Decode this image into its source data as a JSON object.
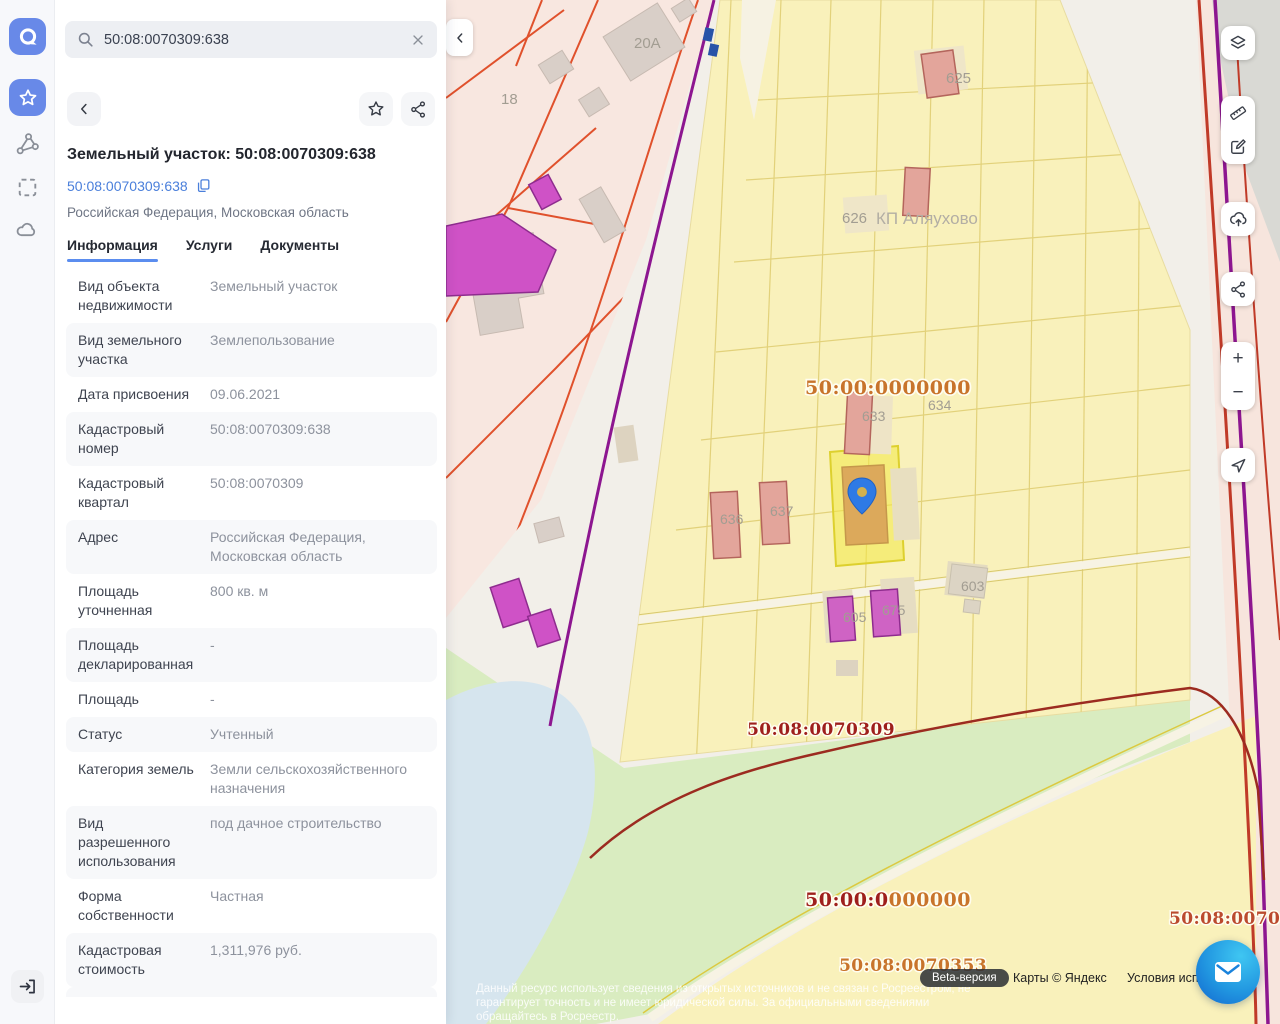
{
  "sidebar": {
    "items": [
      {
        "name": "app-logo"
      },
      {
        "name": "favorites",
        "active": true
      },
      {
        "name": "polygon-tool"
      },
      {
        "name": "select-area-tool"
      },
      {
        "name": "cloud-tool"
      },
      {
        "name": "login"
      }
    ]
  },
  "search": {
    "value": "50:08:0070309:638"
  },
  "panel": {
    "title": "Земельный участок: 50:08:0070309:638",
    "cadastral_link": "50:08:0070309:638",
    "region": "Российская Федерация, Московская область",
    "tabs": [
      {
        "label": "Информация",
        "active": true
      },
      {
        "label": "Услуги",
        "active": false
      },
      {
        "label": "Документы",
        "active": false
      }
    ],
    "rows": [
      {
        "label": "Вид объекта недвижимости",
        "value": "Земельный участок"
      },
      {
        "label": "Вид земельного участка",
        "value": "Землепользование"
      },
      {
        "label": "Дата присвоения",
        "value": "09.06.2021"
      },
      {
        "label": "Кадастровый номер",
        "value": "50:08:0070309:638"
      },
      {
        "label": "Кадастровый квартал",
        "value": "50:08:0070309"
      },
      {
        "label": "Адрес",
        "value": "Российская Федерация, Московская область"
      },
      {
        "label": "Площадь уточненная",
        "value": "800 кв. м"
      },
      {
        "label": "Площадь декларированная",
        "value": "-"
      },
      {
        "label": "Площадь",
        "value": "-"
      },
      {
        "label": "Статус",
        "value": "Учтенный"
      },
      {
        "label": "Категория земель",
        "value": "Земли сельскохозяйственного назначения"
      },
      {
        "label": "Вид разрешенного использования",
        "value": "под дачное строительство"
      },
      {
        "label": "Форма собственности",
        "value": "Частная"
      },
      {
        "label": "Кадастровая стоимость",
        "value": "1,311,976 руб."
      }
    ]
  },
  "map": {
    "quarter_labels": {
      "center": "50:00:0000000",
      "mid": "50:08:0070309",
      "bottom_part1": "50:00:0",
      "bottom_part2": "000000",
      "bottom_full": "50:00:0000000",
      "south": "50:08:0070353",
      "east_clipped": "50:08:00703"
    },
    "village": "КП Аляухово",
    "parcels": {
      "p18": "18",
      "p20a": "20A",
      "p625": "625",
      "p626": "626",
      "p633": "633",
      "p634": "634",
      "p636": "636",
      "p637": "637",
      "p603": "603",
      "p605": "605",
      "p675": "675"
    },
    "attribution": {
      "beta": "Beta-версия",
      "maps_copyright": "Карты © Яндекс",
      "terms": "Условия испол",
      "disclaimer_line1": "Данный ресурс использует сведения из открытых источников и не связан с Росреестром, не",
      "disclaimer_line2": "гарантирует точность и не имеет юридической силы. За официальными сведениями",
      "disclaimer_line3": "обращайтесь в Росреестр."
    },
    "colors": {
      "accent_blue": "#2e7ae5",
      "selected_parcel": "#f3e845",
      "quarter_orange": "#c8742b",
      "quarter_red": "#9e1f1c"
    }
  },
  "controls": {
    "zoom_in": "+",
    "zoom_out": "−"
  }
}
